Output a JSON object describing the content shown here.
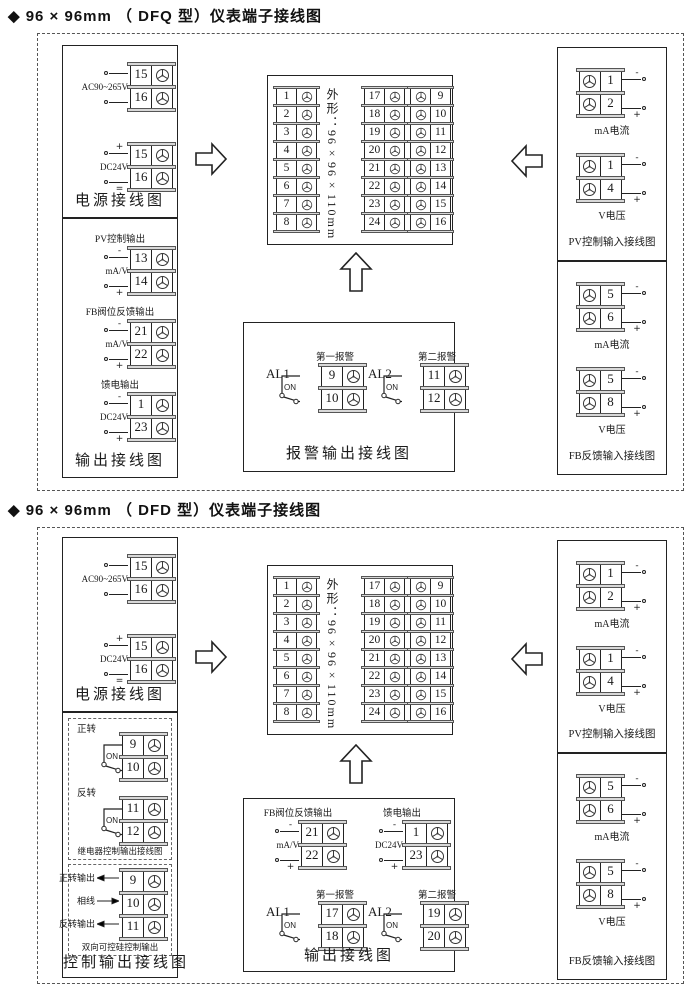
{
  "page": {
    "background": "#ffffff",
    "line_color": "#222222",
    "cap_color": "#d8d8d8"
  },
  "sections": [
    {
      "name": "dfq",
      "title": "◆ 96 × 96mm （ DFQ 型）仪表端子接线图",
      "power_panel": {
        "title": "电源接线图",
        "groups": [
          {
            "label": "AC90~265V",
            "top_sign": "",
            "bottom_sign": "",
            "terminals": [
              "15",
              "16"
            ]
          },
          {
            "label": "DC24V",
            "top_sign": "+",
            "bottom_sign": "=",
            "terminals": [
              "15",
              "16"
            ]
          }
        ]
      },
      "output_panel": {
        "title": "输出接线图",
        "groups": [
          {
            "heading": "PV控制输出",
            "label": "mA/V",
            "top_sign": "-",
            "bottom_sign": "+",
            "terminals": [
              "13",
              "14"
            ]
          },
          {
            "heading": "FB阀位反馈输出",
            "label": "mA/V",
            "top_sign": "-",
            "bottom_sign": "+",
            "terminals": [
              "21",
              "22"
            ]
          },
          {
            "heading": "馈电输出",
            "label": "DC24V",
            "top_sign": "-",
            "bottom_sign": "+",
            "terminals": [
              "1",
              "23"
            ]
          }
        ]
      },
      "center_block": {
        "shape_label": "外形：96×96×110mm",
        "columns": [
          {
            "numbers": [
              "1",
              "2",
              "3",
              "4",
              "5",
              "6",
              "7",
              "8"
            ],
            "num_side": "left"
          },
          {
            "numbers": [
              "17",
              "18",
              "19",
              "20",
              "21",
              "22",
              "23",
              "24"
            ],
            "num_side": "left"
          },
          {
            "numbers": [
              "9",
              "10",
              "11",
              "12",
              "13",
              "14",
              "15",
              "16"
            ],
            "num_side": "right"
          }
        ]
      },
      "alarm_box": {
        "title": "报警输出接线图",
        "groups": [
          {
            "name": "AL1",
            "heading": "第一报警",
            "switch_label": "ON",
            "terminals": [
              "9",
              "10"
            ]
          },
          {
            "name": "AL2",
            "heading": "第二报警",
            "switch_label": "ON",
            "terminals": [
              "11",
              "12"
            ]
          }
        ]
      },
      "input_panels": [
        {
          "title": "PV控制输入接线图",
          "groups": [
            {
              "label": "mA电流",
              "top_sign": "-",
              "bottom_sign": "+",
              "terminals": [
                "1",
                "2"
              ]
            },
            {
              "label": "V电压",
              "top_sign": "-",
              "bottom_sign": "+",
              "terminals": [
                "1",
                "4"
              ]
            }
          ]
        },
        {
          "title": "FB反馈输入接线图",
          "groups": [
            {
              "label": "mA电流",
              "top_sign": "-",
              "bottom_sign": "+",
              "terminals": [
                "5",
                "6"
              ]
            },
            {
              "label": "V电压",
              "top_sign": "-",
              "bottom_sign": "+",
              "terminals": [
                "5",
                "8"
              ]
            }
          ]
        }
      ]
    },
    {
      "name": "dfd",
      "title": "◆ 96 × 96mm （ DFD 型）仪表端子接线图",
      "power_panel": {
        "title": "电源接线图",
        "groups": [
          {
            "label": "AC90~265V",
            "top_sign": "",
            "bottom_sign": "",
            "terminals": [
              "15",
              "16"
            ]
          },
          {
            "label": "DC24V",
            "top_sign": "+",
            "bottom_sign": "=",
            "terminals": [
              "15",
              "16"
            ]
          }
        ]
      },
      "control_panel": {
        "title": "控制输出接线图",
        "relay_box": {
          "caption": "继电器控制输出接线图",
          "groups": [
            {
              "heading": "正转",
              "switch_label": "ON",
              "terminals": [
                "9",
                "10"
              ]
            },
            {
              "heading": "反转",
              "switch_label": "ON",
              "terminals": [
                "11",
                "12"
              ]
            }
          ]
        },
        "scr_box": {
          "caption": "双向可控硅控制输出",
          "rows": [
            {
              "label": "正转输出",
              "arrow": "left",
              "terminal": "9"
            },
            {
              "label": "相线",
              "arrow": "right",
              "terminal": "10"
            },
            {
              "label": "反转输出",
              "arrow": "left",
              "terminal": "11"
            }
          ]
        }
      },
      "center_block": {
        "shape_label": "外形：96×96×110mm",
        "columns": [
          {
            "numbers": [
              "1",
              "2",
              "3",
              "4",
              "5",
              "6",
              "7",
              "8"
            ],
            "num_side": "left"
          },
          {
            "numbers": [
              "17",
              "18",
              "19",
              "20",
              "21",
              "22",
              "23",
              "24"
            ],
            "num_side": "left"
          },
          {
            "numbers": [
              "9",
              "10",
              "11",
              "12",
              "13",
              "14",
              "15",
              "16"
            ],
            "num_side": "right"
          }
        ]
      },
      "output_box": {
        "title": "输出接线图",
        "analog_groups": [
          {
            "heading": "FB阀位反馈输出",
            "label": "mA/V",
            "top_sign": "-",
            "bottom_sign": "+",
            "terminals": [
              "21",
              "22"
            ]
          },
          {
            "heading": "馈电输出",
            "label": "DC24V",
            "top_sign": "-",
            "bottom_sign": "+",
            "terminals": [
              "1",
              "23"
            ]
          }
        ],
        "alarm_groups": [
          {
            "name": "AL1",
            "heading": "第一报警",
            "switch_label": "ON",
            "terminals": [
              "17",
              "18"
            ]
          },
          {
            "name": "AL2",
            "heading": "第二报警",
            "switch_label": "ON",
            "terminals": [
              "19",
              "20"
            ]
          }
        ]
      },
      "input_panels": [
        {
          "title": "PV控制输入接线图",
          "groups": [
            {
              "label": "mA电流",
              "top_sign": "-",
              "bottom_sign": "+",
              "terminals": [
                "1",
                "2"
              ]
            },
            {
              "label": "V电压",
              "top_sign": "-",
              "bottom_sign": "+",
              "terminals": [
                "1",
                "4"
              ]
            }
          ]
        },
        {
          "title": "FB反馈输入接线图",
          "groups": [
            {
              "label": "mA电流",
              "top_sign": "-",
              "bottom_sign": "+",
              "terminals": [
                "5",
                "6"
              ]
            },
            {
              "label": "V电压",
              "top_sign": "-",
              "bottom_sign": "+",
              "terminals": [
                "5",
                "8"
              ]
            }
          ]
        }
      ]
    }
  ]
}
